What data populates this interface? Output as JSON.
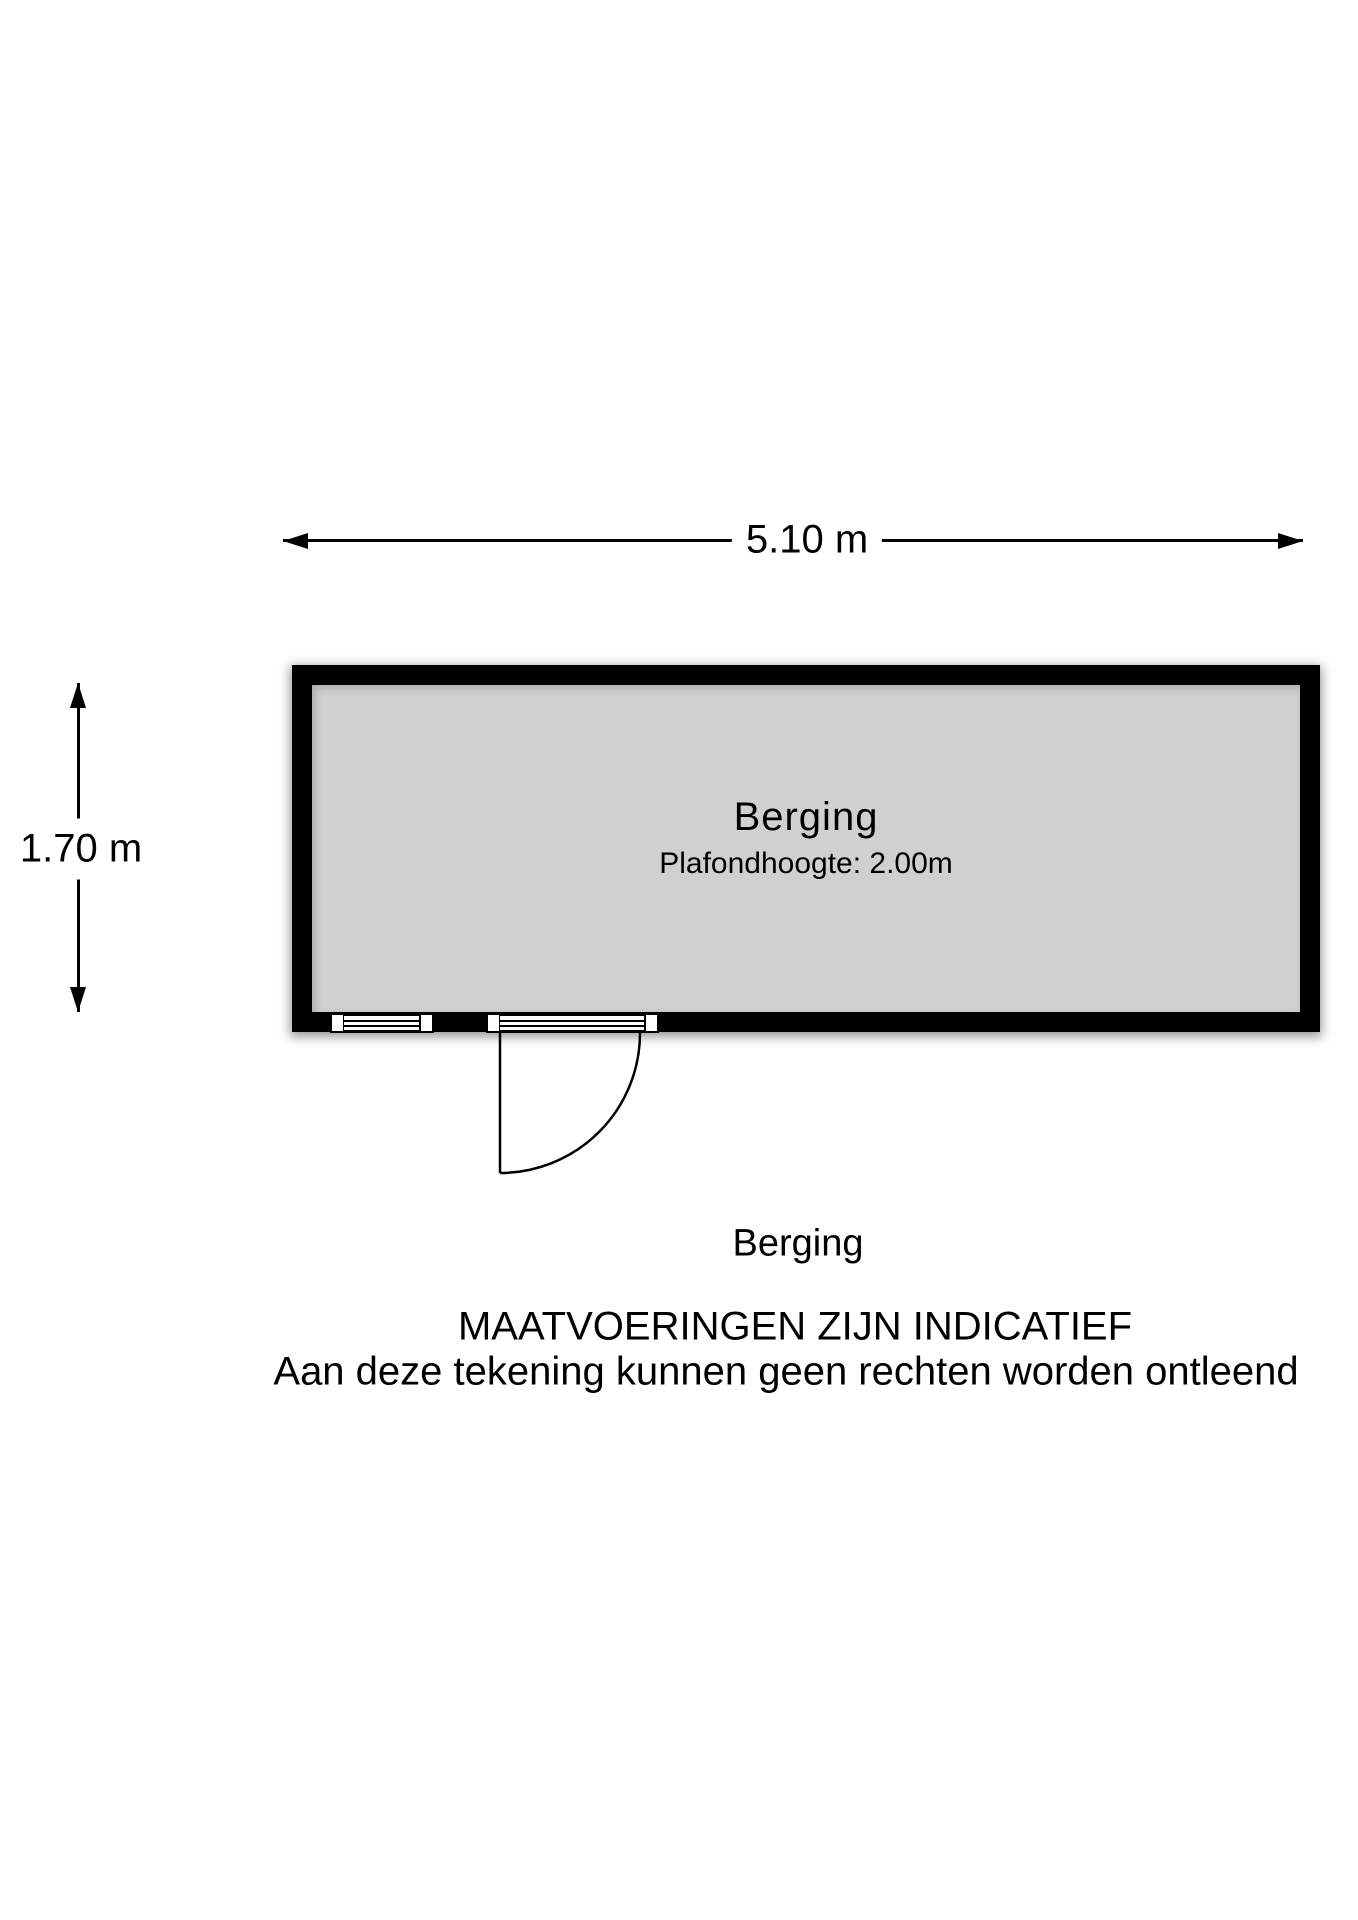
{
  "dimensions": {
    "width_label": "5.10 m",
    "height_label": "1.70 m"
  },
  "room": {
    "name": "Berging",
    "ceiling_height": "Plafondhoogte: 2.00m"
  },
  "caption": "Berging",
  "disclaimer": {
    "line1": "MAATVOERINGEN ZIJN INDICATIEF",
    "line2": "Aan deze tekening kunnen geen rechten worden ontleend"
  },
  "colors": {
    "wall": "#000000",
    "floor": "#d0d0d0",
    "background": "#ffffff"
  }
}
